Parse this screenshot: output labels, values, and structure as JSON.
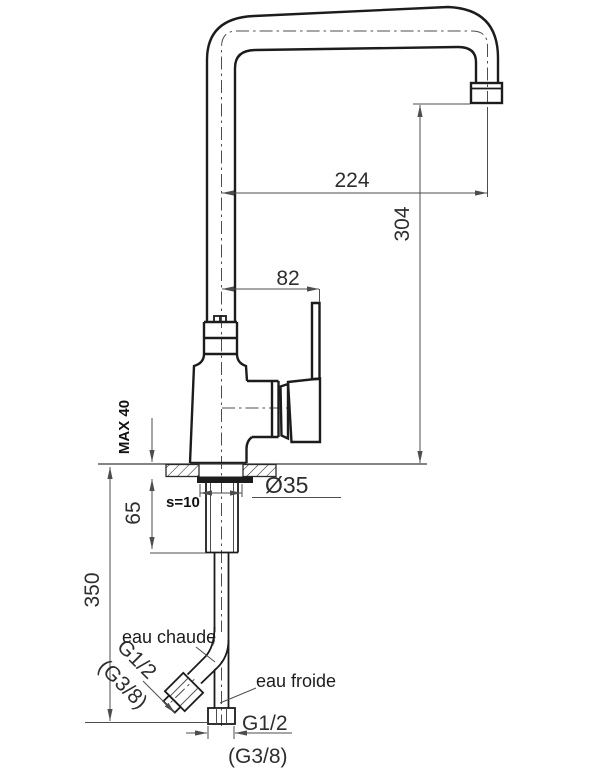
{
  "drawing": {
    "title": "kitchen-faucet-technical-drawing",
    "dims": {
      "spout_reach": "224",
      "spout_height": "304",
      "handle_offset": "82",
      "max_counter_thickness": "MAX 40",
      "shank_length": "65",
      "hose_length": "350",
      "hole_diameter": "Ø35",
      "washer_thickness": "s=10",
      "cold_thread": "G1/2",
      "cold_thread_alt": "(G3/8)",
      "hot_thread": "G1/2",
      "hot_thread_alt": "(G3/8)"
    },
    "labels": {
      "hot_water": "eau chaude",
      "cold_water": "eau froide"
    },
    "colors": {
      "outline": "#1c1c1c",
      "dimension": "#4d4d4d",
      "background": "#ffffff"
    }
  }
}
